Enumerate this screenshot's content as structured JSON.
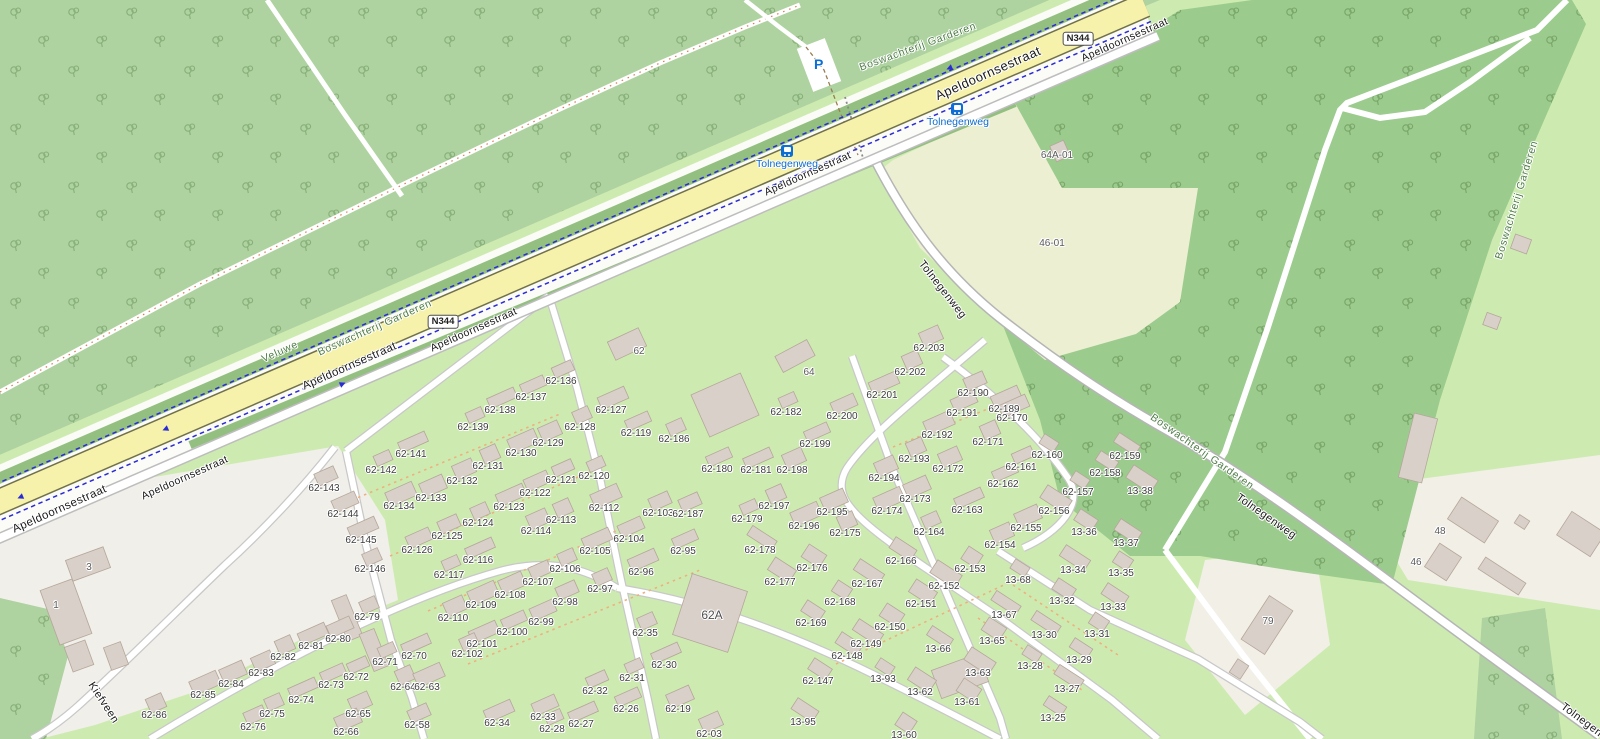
{
  "map": {
    "colors": {
      "park_green": "#cdebb0",
      "forest_light": "#aed2a0",
      "forest_dark": "#9ccb8e",
      "field_pale": "#ecefd2",
      "yard_gray": "#f1efe9",
      "hedge": "#93bf80",
      "road_yellow": "#f6f2ab",
      "road_yellow_casing": "#70704a",
      "road_white": "#ffffff",
      "road_casing": "#c8c8c8",
      "cycleway_blue": "#2b2bd5",
      "building_fill": "#d9d0c9",
      "building_stroke": "#b5a79a",
      "transit_blue": "#0b6fd6",
      "label_green": "#4e7d46",
      "footpath_red_dash": "#e07858",
      "track_brown_dash": "#9a7d4f",
      "drive_orange_dash": "#eeb07f"
    },
    "shields": [
      {
        "t": "N344",
        "x": 443,
        "y": 322
      },
      {
        "t": "N344",
        "x": 1078,
        "y": 39
      }
    ],
    "road_labels": [
      {
        "t": "Apeldoornsestraat",
        "x": 60,
        "y": 510,
        "r": -24,
        "s": 11.5
      },
      {
        "t": "Apeldoornsestraat",
        "x": 350,
        "y": 367,
        "r": -24,
        "s": 11.5
      },
      {
        "t": "Apeldoornsestraat",
        "x": 988,
        "y": 73,
        "r": -24,
        "s": 13
      },
      {
        "t": "Apeldoornsestraat",
        "x": 185,
        "y": 478,
        "r": -24,
        "s": 10.5
      },
      {
        "t": "Apeldoornsestraat",
        "x": 474,
        "y": 330,
        "r": -24,
        "s": 10.5
      },
      {
        "t": "Apeldoornsestraat",
        "x": 808,
        "y": 174,
        "r": -24,
        "s": 10.5
      },
      {
        "t": "Apeldoornsestraat",
        "x": 1125,
        "y": 40,
        "r": -24,
        "s": 10.5
      },
      {
        "t": "Tolnegenweg",
        "x": 942,
        "y": 290,
        "r": 52,
        "s": 11
      },
      {
        "t": "Tolnegenweg",
        "x": 1266,
        "y": 517,
        "r": 35,
        "s": 11
      },
      {
        "t": "Tolnegenweg",
        "x": 1590,
        "y": 727,
        "r": 37,
        "s": 11
      },
      {
        "t": "Kiefveen",
        "x": 103,
        "y": 703,
        "r": 57,
        "s": 11
      }
    ],
    "area_labels": [
      {
        "t": "Boswachterij Garderen",
        "x": 918,
        "y": 47,
        "r": -20
      },
      {
        "t": "Boswachterij Garderen",
        "x": 375,
        "y": 328,
        "r": -24
      },
      {
        "t": "Boswachterij Garderen",
        "x": 1202,
        "y": 452,
        "r": 35
      },
      {
        "t": "Boswachterij Garderen",
        "x": 1517,
        "y": 200,
        "r": -73
      },
      {
        "t": "Veluwe",
        "x": 280,
        "y": 352,
        "r": -24
      }
    ],
    "transit": {
      "parking_symbol": "P",
      "parking": {
        "x": 814,
        "y": 57
      },
      "bus_stops": [
        {
          "t": "Tolnegenweg",
          "lx": 787,
          "ly": 164,
          "ix": 781,
          "iy": 145
        },
        {
          "t": "Tolnegenweg",
          "lx": 958,
          "ly": 122,
          "ix": 951,
          "iy": 103
        }
      ]
    },
    "site_labels": [
      {
        "t": "62",
        "x": 639,
        "y": 352
      },
      {
        "t": "64",
        "x": 809,
        "y": 373
      },
      {
        "t": "62A",
        "x": 712,
        "y": 615,
        "big": true
      },
      {
        "t": "64A-01",
        "x": 1057,
        "y": 156
      },
      {
        "t": "46-01",
        "x": 1052,
        "y": 244
      },
      {
        "t": "48",
        "x": 1440,
        "y": 532
      },
      {
        "t": "46",
        "x": 1416,
        "y": 563
      },
      {
        "t": "79",
        "x": 1268,
        "y": 622
      },
      {
        "t": "1",
        "x": 56,
        "y": 606
      },
      {
        "t": "3",
        "x": 89,
        "y": 568
      }
    ],
    "house_labels": [
      [
        "62-136",
        561,
        382
      ],
      [
        "62-137",
        531,
        398
      ],
      [
        "62-138",
        500,
        411
      ],
      [
        "62-139",
        473,
        428
      ],
      [
        "62-141",
        411,
        455
      ],
      [
        "62-142",
        381,
        471
      ],
      [
        "62-143",
        324,
        489
      ],
      [
        "62-144",
        343,
        515
      ],
      [
        "62-145",
        361,
        541
      ],
      [
        "62-146",
        370,
        570
      ],
      [
        "62-127",
        611,
        411
      ],
      [
        "62-128",
        580,
        428
      ],
      [
        "62-129",
        548,
        444
      ],
      [
        "62-130",
        521,
        454
      ],
      [
        "62-131",
        488,
        467
      ],
      [
        "62-132",
        462,
        482
      ],
      [
        "62-133",
        431,
        499
      ],
      [
        "62-134",
        399,
        507
      ],
      [
        "62-119",
        636,
        434
      ],
      [
        "62-186",
        674,
        440
      ],
      [
        "62-120",
        594,
        477
      ],
      [
        "62-121",
        561,
        481
      ],
      [
        "62-122",
        535,
        494
      ],
      [
        "62-123",
        509,
        508
      ],
      [
        "62-124",
        478,
        524
      ],
      [
        "62-125",
        447,
        537
      ],
      [
        "62-126",
        417,
        551
      ],
      [
        "62-116",
        478,
        561
      ],
      [
        "62-117",
        449,
        576
      ],
      [
        "62-112",
        604,
        509
      ],
      [
        "62-113",
        561,
        521
      ],
      [
        "62-114",
        536,
        532
      ],
      [
        "62-103",
        658,
        514
      ],
      [
        "62-187",
        688,
        515
      ],
      [
        "62-104",
        629,
        540
      ],
      [
        "62-105",
        595,
        552
      ],
      [
        "62-106",
        565,
        570
      ],
      [
        "62-107",
        538,
        583
      ],
      [
        "62-108",
        510,
        596
      ],
      [
        "62-109",
        481,
        606
      ],
      [
        "62-110",
        453,
        619
      ],
      [
        "62-95",
        683,
        552
      ],
      [
        "62-96",
        641,
        573
      ],
      [
        "62-97",
        600,
        590
      ],
      [
        "62-98",
        565,
        603
      ],
      [
        "62-99",
        541,
        623
      ],
      [
        "62-100",
        512,
        633
      ],
      [
        "62-101",
        482,
        645
      ],
      [
        "62-102",
        467,
        655
      ],
      [
        "62-79",
        367,
        618
      ],
      [
        "62-80",
        338,
        640
      ],
      [
        "62-81",
        311,
        647
      ],
      [
        "62-82",
        283,
        658
      ],
      [
        "62-83",
        261,
        674
      ],
      [
        "62-84",
        231,
        685
      ],
      [
        "62-85",
        203,
        696
      ],
      [
        "62-86",
        154,
        716
      ],
      [
        "62-70",
        414,
        657
      ],
      [
        "62-71",
        385,
        663
      ],
      [
        "62-72",
        356,
        678
      ],
      [
        "62-73",
        331,
        686
      ],
      [
        "62-74",
        301,
        701
      ],
      [
        "62-75",
        272,
        715
      ],
      [
        "62-76",
        253,
        728
      ],
      [
        "62-64",
        403,
        688
      ],
      [
        "62-63",
        427,
        688
      ],
      [
        "62-65",
        358,
        715
      ],
      [
        "62-66",
        346,
        733
      ],
      [
        "62-58",
        417,
        726
      ],
      [
        "62-35",
        645,
        634
      ],
      [
        "62-30",
        664,
        666
      ],
      [
        "62-31",
        632,
        679
      ],
      [
        "62-32",
        595,
        692
      ],
      [
        "62-33",
        543,
        718
      ],
      [
        "62-34",
        497,
        724
      ],
      [
        "62-26",
        626,
        710
      ],
      [
        "62-27",
        581,
        725
      ],
      [
        "62-28",
        552,
        730
      ],
      [
        "62-19",
        678,
        710
      ],
      [
        "62-03",
        709,
        735
      ],
      [
        "62-180",
        717,
        470
      ],
      [
        "62-181",
        756,
        471
      ],
      [
        "62-198",
        792,
        471
      ],
      [
        "62-182",
        786,
        413
      ],
      [
        "62-199",
        815,
        445
      ],
      [
        "62-200",
        842,
        417
      ],
      [
        "62-201",
        882,
        396
      ],
      [
        "62-202",
        910,
        373
      ],
      [
        "62-203",
        929,
        349
      ],
      [
        "62-190",
        973,
        394
      ],
      [
        "62-191",
        962,
        414
      ],
      [
        "62-189",
        1004,
        410
      ],
      [
        "62-170",
        1012,
        419
      ],
      [
        "62-192",
        937,
        436
      ],
      [
        "62-171",
        988,
        443
      ],
      [
        "62-193",
        914,
        460
      ],
      [
        "62-172",
        948,
        470
      ],
      [
        "62-161",
        1021,
        468
      ],
      [
        "62-194",
        884,
        479
      ],
      [
        "62-162",
        1003,
        485
      ],
      [
        "62-173",
        915,
        500
      ],
      [
        "62-163",
        967,
        511
      ],
      [
        "62-197",
        774,
        507
      ],
      [
        "62-195",
        832,
        513
      ],
      [
        "62-179",
        747,
        520
      ],
      [
        "62-196",
        804,
        527
      ],
      [
        "62-174",
        887,
        512
      ],
      [
        "62-175",
        845,
        534
      ],
      [
        "62-164",
        929,
        533
      ],
      [
        "62-178",
        760,
        551
      ],
      [
        "62-176",
        812,
        569
      ],
      [
        "62-177",
        780,
        583
      ],
      [
        "62-166",
        901,
        562
      ],
      [
        "62-167",
        867,
        585
      ],
      [
        "62-168",
        840,
        603
      ],
      [
        "62-169",
        811,
        624
      ],
      [
        "62-150",
        890,
        628
      ],
      [
        "62-149",
        866,
        645
      ],
      [
        "62-148",
        847,
        657
      ],
      [
        "62-151",
        921,
        605
      ],
      [
        "62-152",
        944,
        587
      ],
      [
        "62-153",
        970,
        570
      ],
      [
        "62-154",
        1000,
        546
      ],
      [
        "62-155",
        1026,
        529
      ],
      [
        "62-147",
        818,
        682
      ],
      [
        "62-160",
        1047,
        456
      ],
      [
        "62-159",
        1125,
        457
      ],
      [
        "62-158",
        1105,
        474
      ],
      [
        "62-157",
        1078,
        493
      ],
      [
        "62-156",
        1054,
        512
      ],
      [
        "13-38",
        1140,
        492
      ],
      [
        "13-36",
        1084,
        533
      ],
      [
        "13-37",
        1126,
        544
      ],
      [
        "13-34",
        1073,
        571
      ],
      [
        "13-35",
        1121,
        574
      ],
      [
        "13-68",
        1018,
        581
      ],
      [
        "13-32",
        1062,
        602
      ],
      [
        "13-33",
        1113,
        608
      ],
      [
        "13-67",
        1004,
        616
      ],
      [
        "13-30",
        1044,
        636
      ],
      [
        "13-31",
        1097,
        635
      ],
      [
        "13-65",
        992,
        642
      ],
      [
        "13-66",
        938,
        650
      ],
      [
        "13-29",
        1079,
        661
      ],
      [
        "13-28",
        1030,
        667
      ],
      [
        "13-93",
        883,
        680
      ],
      [
        "13-62",
        920,
        693
      ],
      [
        "13-63",
        978,
        674
      ],
      [
        "13-61",
        967,
        703
      ],
      [
        "13-27",
        1067,
        690
      ],
      [
        "13-95",
        803,
        723
      ],
      [
        "13-25",
        1053,
        719
      ],
      [
        "13-60",
        904,
        736
      ]
    ],
    "structures": [
      [
        725,
        405,
        54,
        46,
        -24
      ],
      [
        710,
        613,
        58,
        64,
        18
      ],
      [
        627,
        344,
        34,
        20,
        -25
      ],
      [
        795,
        356,
        36,
        18,
        -28
      ],
      [
        66,
        612,
        34,
        58,
        -20
      ],
      [
        88,
        564,
        40,
        22,
        -20
      ],
      [
        79,
        656,
        22,
        26,
        -20
      ],
      [
        116,
        656,
        18,
        24,
        -20
      ],
      [
        347,
        618,
        16,
        44,
        -22
      ],
      [
        374,
        650,
        16,
        40,
        -22
      ],
      [
        960,
        676,
        50,
        30,
        -20
      ],
      [
        1418,
        448,
        24,
        66,
        14
      ],
      [
        1473,
        520,
        44,
        26,
        33
      ],
      [
        1522,
        522,
        12,
        10,
        33
      ],
      [
        1581,
        534,
        40,
        28,
        33
      ],
      [
        1502,
        576,
        48,
        14,
        33
      ],
      [
        1443,
        562,
        26,
        28,
        33
      ],
      [
        1267,
        625,
        28,
        52,
        33
      ],
      [
        1239,
        669,
        13,
        16,
        33
      ],
      [
        1060,
        151,
        15,
        17,
        -24
      ],
      [
        1521,
        244,
        15,
        17,
        -70
      ],
      [
        1492,
        321,
        13,
        15,
        -70
      ]
    ],
    "arrows": [
      {
        "x": 23,
        "y": 496,
        "r": 157
      },
      {
        "x": 168,
        "y": 428,
        "r": 157
      },
      {
        "x": 340,
        "y": 385,
        "r": -23
      },
      {
        "x": 952,
        "y": 67,
        "r": 157
      }
    ]
  }
}
